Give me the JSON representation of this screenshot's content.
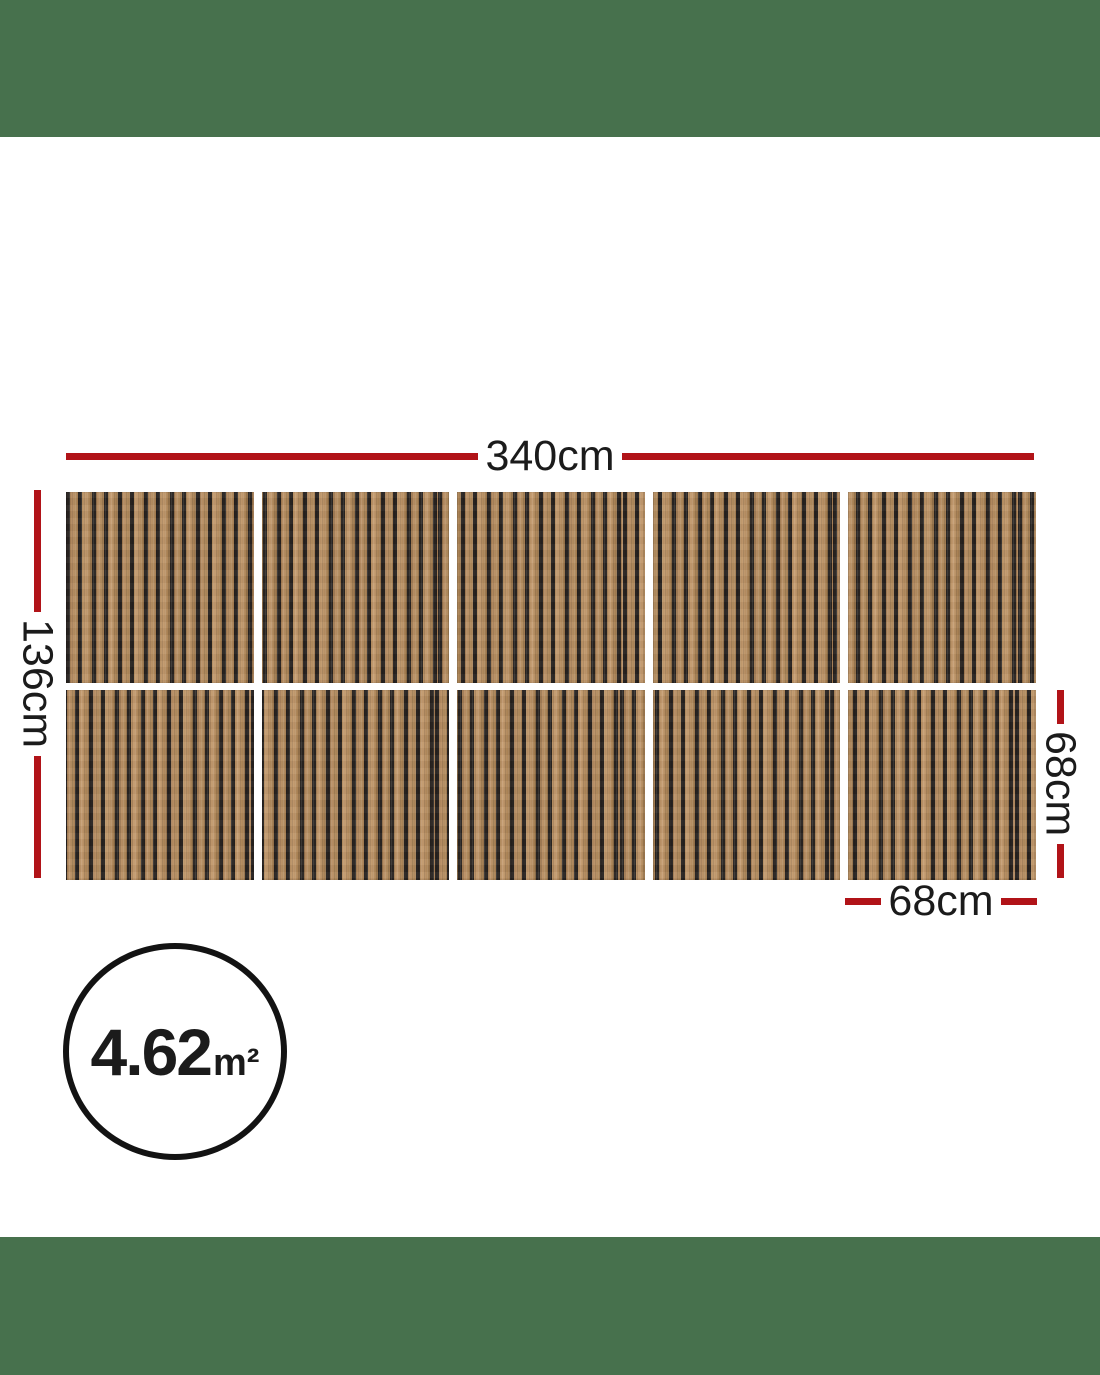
{
  "dimensions": {
    "total_width": "340cm",
    "total_height": "136cm",
    "panel_height": "68cm",
    "panel_width": "68cm"
  },
  "area_badge": {
    "value": "4.62",
    "unit": "m²"
  },
  "panel_grid": {
    "rows": 2,
    "columns": 5,
    "panel_count": 10
  },
  "colors": {
    "band_green": "#47714d",
    "dim_red": "#b11318",
    "text_dark": "#1b1b1b",
    "wood_light": "#bb9166",
    "wood_mid": "#b08a5c",
    "wood_dark": "#8f6d46",
    "slat_gap": "#282320",
    "circle_border": "#131313"
  }
}
